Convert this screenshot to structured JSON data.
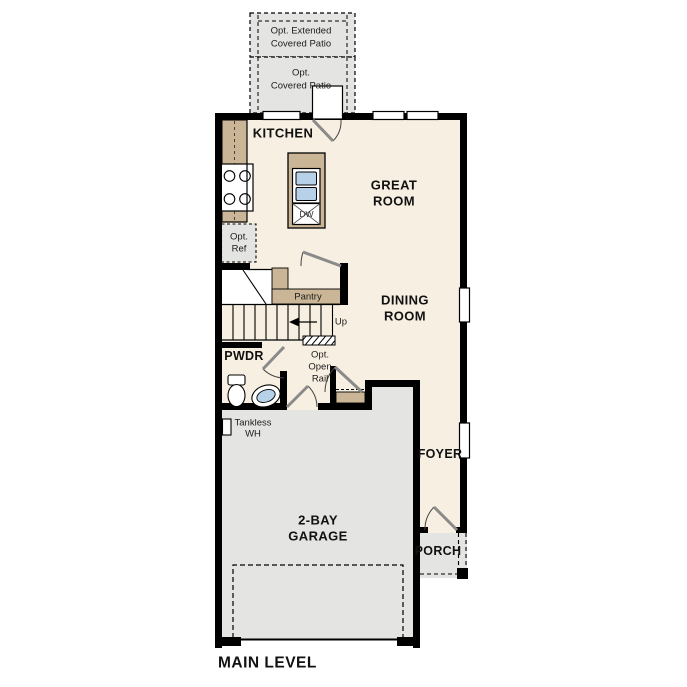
{
  "colors": {
    "interior": "#f7efe1",
    "exterior": "#e4e4e2",
    "casework": "#cab697",
    "water": "#b7d2e8",
    "wall": "#000000"
  },
  "labels": {
    "kitchen": "KITCHEN",
    "great_room": [
      "GREAT",
      "ROOM"
    ],
    "dining_room": [
      "DINING",
      "ROOM"
    ],
    "pwdr": "PWDR",
    "foyer": "FOYER",
    "porch": "PORCH",
    "garage": [
      "2-BAY",
      "GARAGE"
    ],
    "pantry": "Pantry",
    "up": "Up",
    "open_rail": [
      "Opt.",
      "Open",
      "Rail"
    ],
    "tankless": [
      "Tankless",
      "WH"
    ],
    "opt_ref": [
      "Opt.",
      "Ref"
    ],
    "dw": "DW",
    "patio_extended": [
      "Opt. Extended",
      "Covered Patio"
    ],
    "patio_covered": [
      "Opt.",
      "Covered Patio"
    ],
    "main_level": "MAIN LEVEL"
  }
}
